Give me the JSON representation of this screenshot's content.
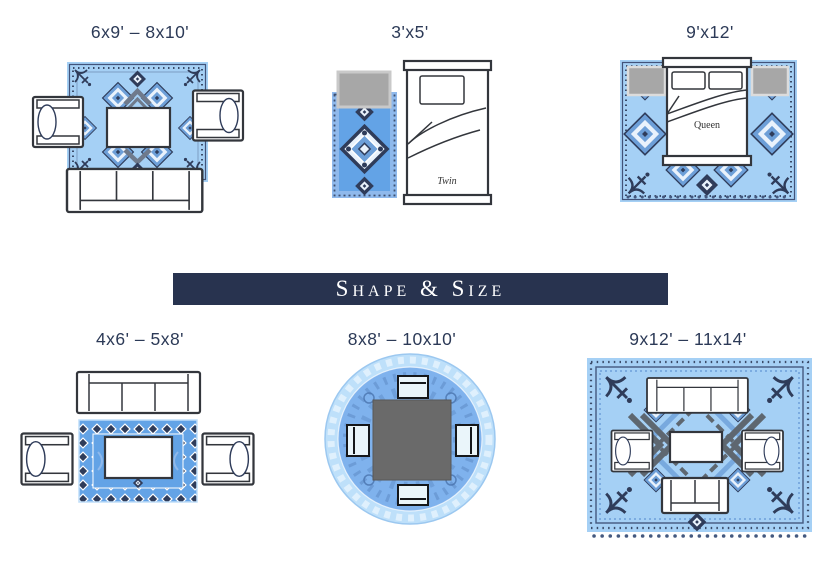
{
  "banner": {
    "label": "Shape & Size"
  },
  "panels": [
    {
      "name": "living-room-medium",
      "label": "6x9' – 8x10'"
    },
    {
      "name": "twin-bedroom",
      "label": "3'x5'",
      "bed_label": "Twin"
    },
    {
      "name": "queen-bedroom",
      "label": "9'x12'",
      "bed_label": "Queen"
    },
    {
      "name": "living-room-small",
      "label": "4x6' – 5x8'"
    },
    {
      "name": "dining-round",
      "label": "8x8' – 10x10'"
    },
    {
      "name": "living-room-large",
      "label": "9x12' – 11x14'"
    }
  ],
  "colors": {
    "banner-bg": "#28334F",
    "label-text": "#2C3A57",
    "rug-light": "#A5D0F5",
    "rug-medium": "#63A3E6",
    "rug-band": "#8FB9EC",
    "round-ring": "#BEE0FA",
    "round-inner": "#7FB2ED",
    "motif-dark": "#2F3C5A",
    "motif-mid": "#6D9FD8",
    "furniture-gray": "#A7A7A7",
    "table-gray": "#6A6A6A",
    "outline": "#33363C"
  }
}
